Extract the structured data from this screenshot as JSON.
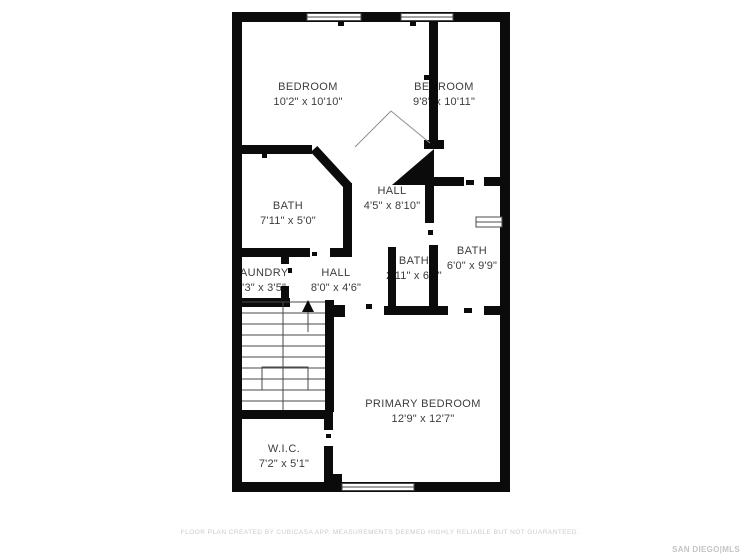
{
  "plan": {
    "rooms": [
      {
        "name": "BEDROOM",
        "dims": "10'2\" x 10'10\""
      },
      {
        "name": "BEDROOM",
        "dims": "9'8\" x 10'11\""
      },
      {
        "name": "HALL",
        "dims": "4'5\" x 8'10\""
      },
      {
        "name": "BATH",
        "dims": "7'11\" x 5'0\""
      },
      {
        "name": "LAUNDRY",
        "dims": "3'3\" x 3'5\""
      },
      {
        "name": "HALL",
        "dims": "8'0\" x 4'6\""
      },
      {
        "name": "BATH",
        "dims": "2'11\" x 6'6\""
      },
      {
        "name": "BATH",
        "dims": "6'0\" x 9'9\""
      },
      {
        "name": "PRIMARY BEDROOM",
        "dims": "12'9\" x 12'7\""
      },
      {
        "name": "W.I.C.",
        "dims": "7'2\" x 5'1\""
      }
    ],
    "colors": {
      "wall": "#0b0b0b",
      "label_text": "#3c3c3c",
      "stair_line": "#4a4a4a",
      "muted_text": "#cbcbcb"
    },
    "icons": {
      "stairs_direction": "up-arrow-icon"
    },
    "footer_disclaimer": "FLOOR PLAN CREATED BY CUBICASA APP. MEASUREMENTS DEEMED HIGHLY RELIABLE BUT NOT GUARANTEED.",
    "brand_logo": "SAN DIEGO|MLS"
  }
}
